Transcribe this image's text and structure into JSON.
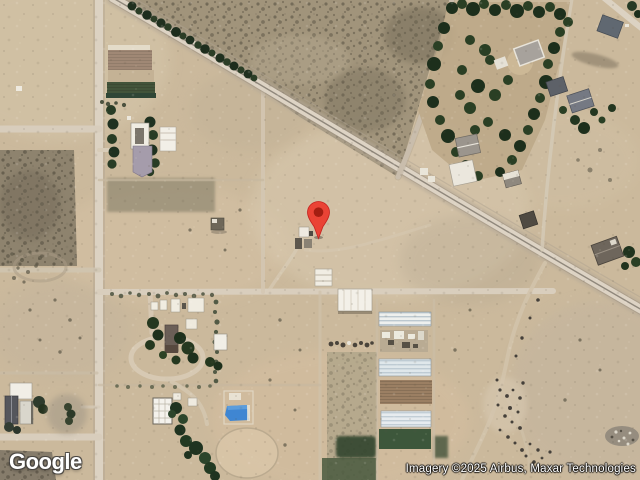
{
  "page": {
    "type": "map-view",
    "mode": "satellite"
  },
  "branding": {
    "logo_text": "Google"
  },
  "attribution": {
    "text": "Imagery ©2025 Airbus, Maxar Technologies"
  },
  "marker": {
    "icon": "location-pin-icon",
    "tip_x": 318,
    "tip_y": 239
  },
  "colors": {
    "marker_red": "#EA4335",
    "marker_core": "#A31E12",
    "marker_outline": "#C5221F",
    "pond_blue": "#3F86D2",
    "terrain_tan": "#CBB99C",
    "road_light": "#DBD1C1",
    "tree_green": "#24371F"
  }
}
